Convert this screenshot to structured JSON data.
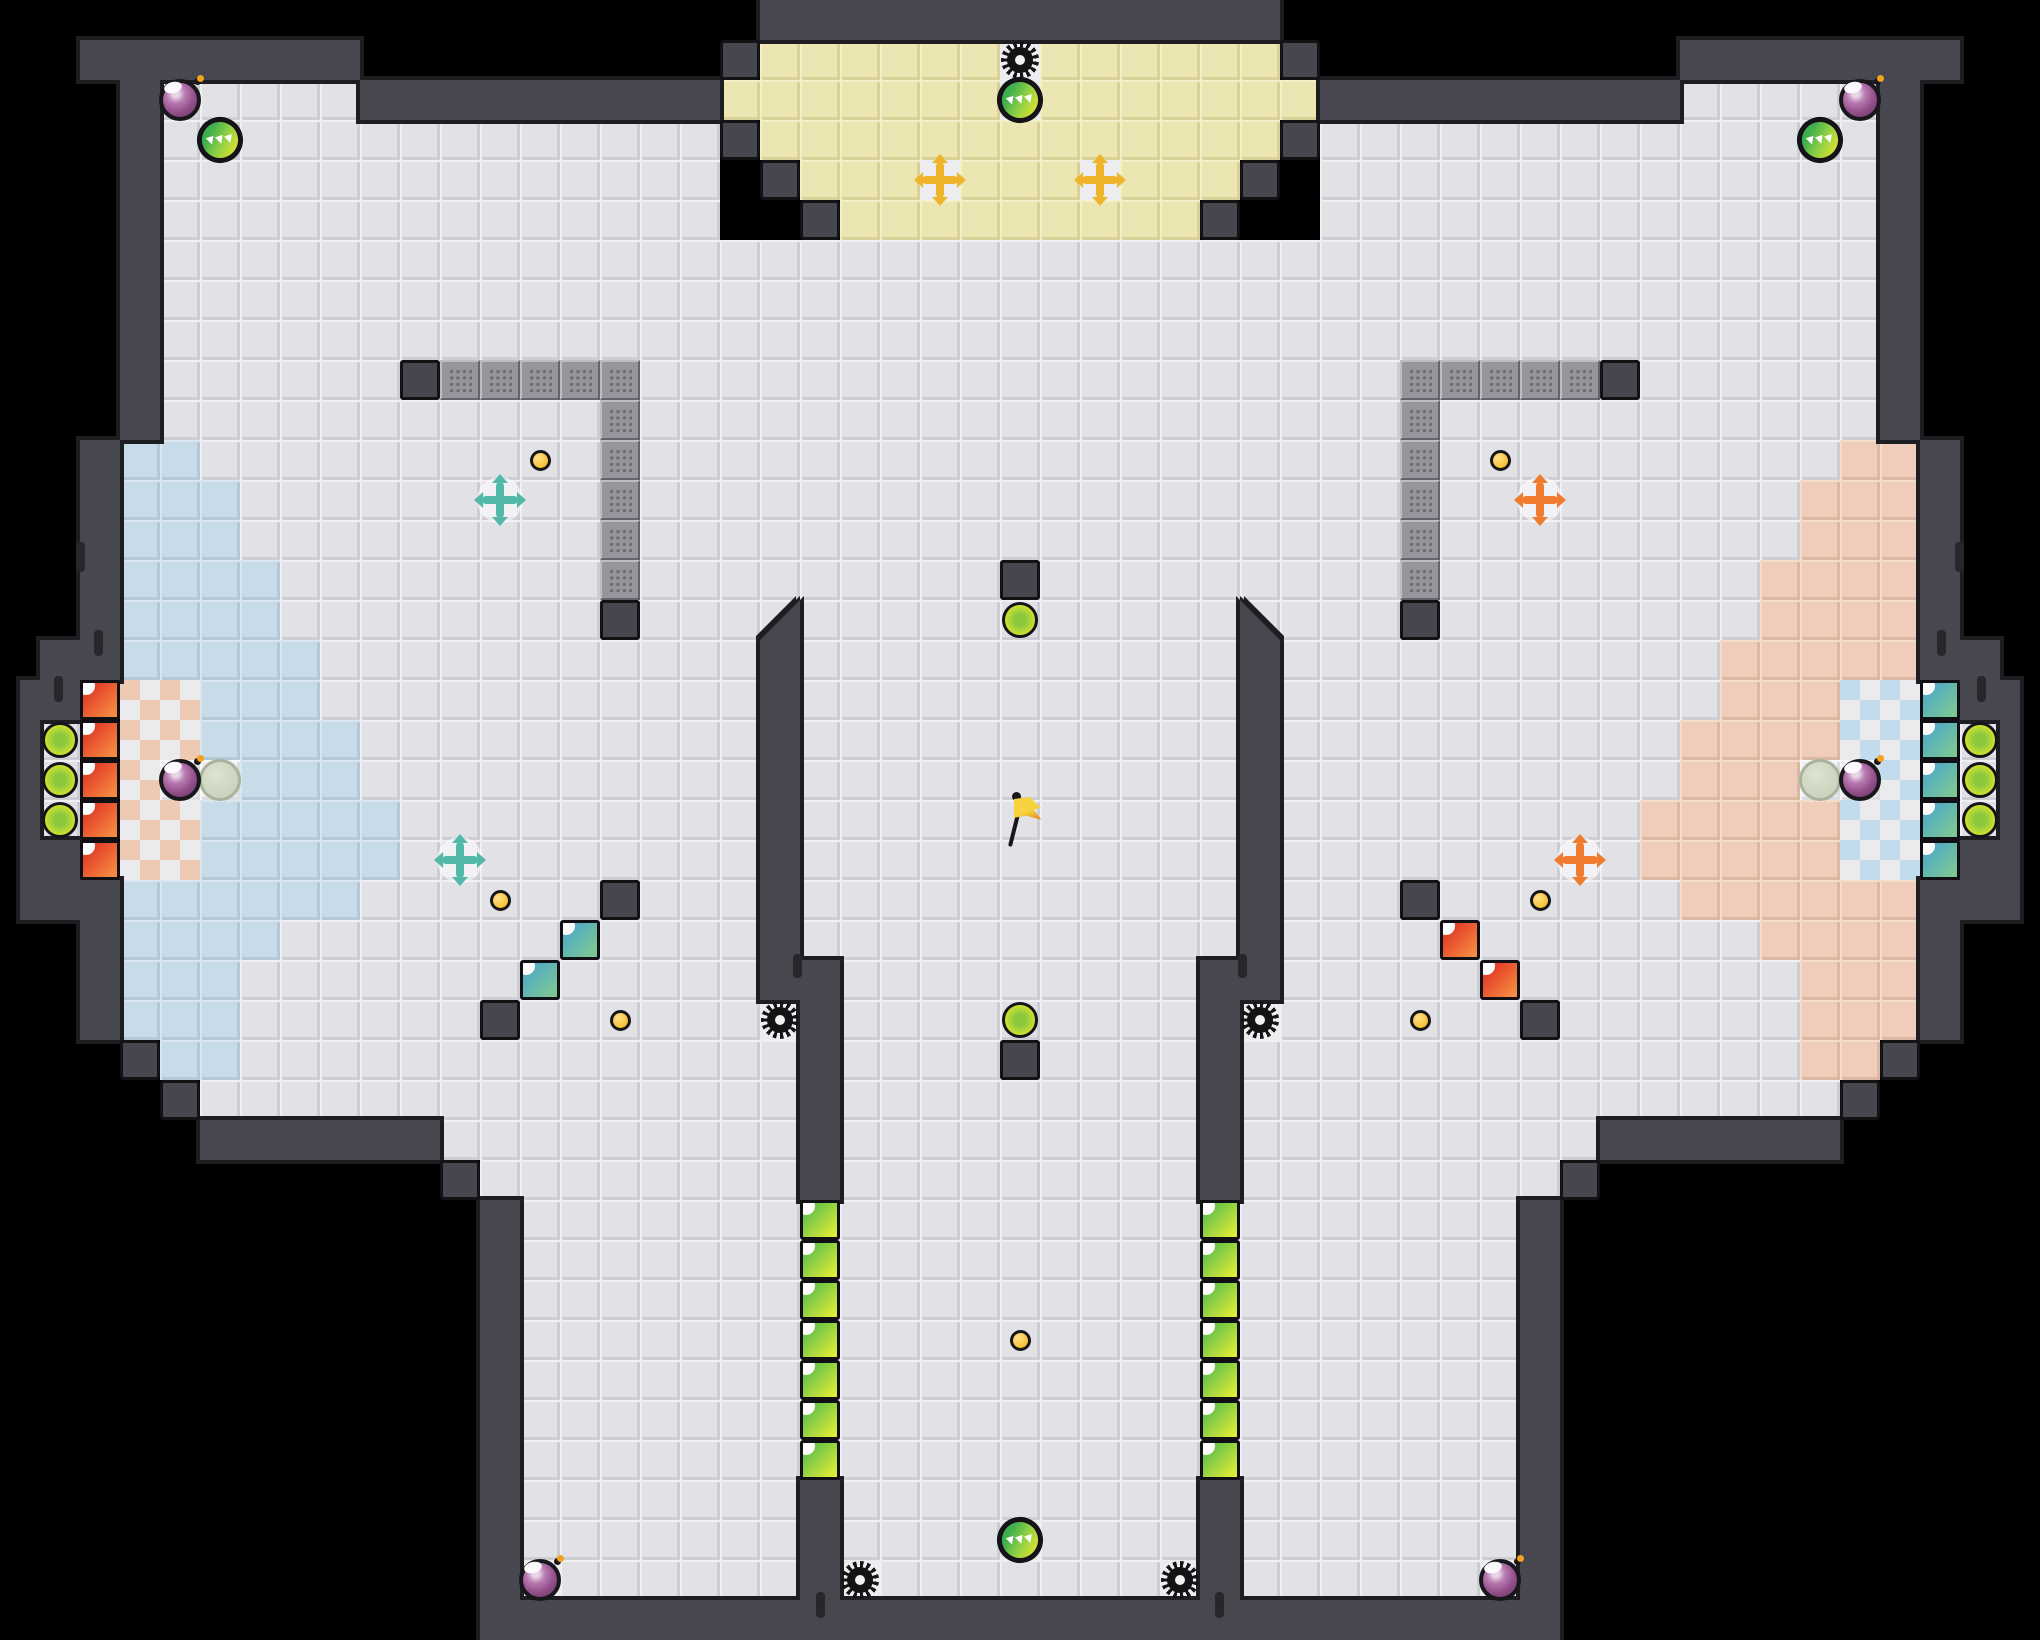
{
  "title": "tile arena map",
  "palette": {
    "background": "#000000",
    "wall_fill": "#47474f",
    "wall_outline": "#1d1d22",
    "floor_gray": "#e2e2e6",
    "floor_yellow": "#ece7b2",
    "floor_blue": "#c8dbe9",
    "floor_pink": "#f0cdba",
    "checker_left_accent": "#eec9b4",
    "checker_right_accent": "#c2dcee",
    "crate_red": "#e8452e",
    "crate_teal": "#58aec6",
    "crate_green": "#6fbf52",
    "cross_teal": "#53b8a8",
    "cross_orange": "#f07c30",
    "cross_gold": "#f0b42a",
    "orb_yellow_green": "#cfe32c",
    "bomb_purple": "#94518c",
    "gear_black": "#141417",
    "dot_gold": "#f3b512"
  },
  "map": {
    "tile": 40,
    "width": 2040,
    "height": 1640,
    "floors": {
      "gray": [
        [
          160,
          80,
          200,
          40
        ],
        [
          1680,
          80,
          200,
          40
        ],
        [
          160,
          120,
          560,
          120
        ],
        [
          1320,
          120,
          560,
          120
        ],
        [
          160,
          240,
          1720,
          200
        ],
        [
          120,
          440,
          1800,
          200
        ],
        [
          120,
          640,
          1800,
          40
        ],
        [
          160,
          680,
          1720,
          200
        ],
        [
          40,
          720,
          40,
          120
        ],
        [
          1960,
          720,
          40,
          120
        ],
        [
          120,
          880,
          1800,
          160
        ],
        [
          160,
          1040,
          1720,
          40
        ],
        [
          200,
          1080,
          1640,
          40
        ],
        [
          440,
          1120,
          1160,
          40
        ],
        [
          480,
          1160,
          1080,
          40
        ],
        [
          520,
          1200,
          1000,
          400
        ]
      ],
      "yellow": [
        [
          760,
          40,
          520,
          40
        ],
        [
          720,
          80,
          600,
          40
        ],
        [
          760,
          120,
          520,
          40
        ],
        [
          800,
          160,
          440,
          40
        ],
        [
          840,
          200,
          360,
          40
        ]
      ],
      "blue": [
        [
          120,
          440,
          80,
          40
        ],
        [
          120,
          480,
          120,
          40
        ],
        [
          120,
          520,
          120,
          40
        ],
        [
          120,
          560,
          160,
          40
        ],
        [
          120,
          600,
          160,
          40
        ],
        [
          120,
          640,
          200,
          40
        ],
        [
          160,
          680,
          160,
          40
        ],
        [
          160,
          720,
          200,
          40
        ],
        [
          240,
          760,
          120,
          40
        ],
        [
          160,
          800,
          240,
          40
        ],
        [
          160,
          840,
          240,
          40
        ],
        [
          120,
          880,
          240,
          40
        ],
        [
          120,
          920,
          160,
          40
        ],
        [
          120,
          960,
          120,
          40
        ],
        [
          120,
          1000,
          120,
          40
        ],
        [
          160,
          1040,
          80,
          40
        ]
      ],
      "pink": [
        [
          1840,
          440,
          80,
          40
        ],
        [
          1800,
          480,
          120,
          40
        ],
        [
          1800,
          520,
          120,
          40
        ],
        [
          1760,
          560,
          160,
          40
        ],
        [
          1760,
          600,
          160,
          40
        ],
        [
          1720,
          640,
          200,
          40
        ],
        [
          1720,
          680,
          160,
          40
        ],
        [
          1680,
          720,
          200,
          40
        ],
        [
          1680,
          760,
          120,
          40
        ],
        [
          1640,
          800,
          240,
          40
        ],
        [
          1640,
          840,
          240,
          40
        ],
        [
          1680,
          880,
          240,
          40
        ],
        [
          1760,
          920,
          160,
          40
        ],
        [
          1800,
          960,
          120,
          40
        ],
        [
          1800,
          1000,
          120,
          40
        ],
        [
          1800,
          1040,
          80,
          40
        ]
      ],
      "white": [
        [
          160,
          760,
          80,
          40
        ],
        [
          1800,
          760,
          80,
          40
        ]
      ],
      "pads": [
        [
          1000,
          40
        ],
        [
          1000,
          80
        ],
        [
          920,
          160
        ],
        [
          1080,
          160
        ],
        [
          760,
          1000
        ],
        [
          1240,
          1000
        ],
        [
          840,
          1560
        ],
        [
          1160,
          1560
        ],
        [
          1000,
          1520
        ],
        [
          520,
          1560
        ],
        [
          1480,
          1560
        ]
      ]
    },
    "checkers": {
      "left": [
        [
          120,
          680,
          40,
          200
        ],
        [
          160,
          680,
          40,
          80
        ],
        [
          160,
          800,
          40,
          80
        ]
      ],
      "right": [
        [
          1880,
          680,
          40,
          200
        ],
        [
          1840,
          680,
          40,
          80
        ],
        [
          1840,
          800,
          40,
          80
        ]
      ]
    },
    "bricks": [
      [
        440,
        360,
        200,
        40
      ],
      [
        600,
        400,
        40,
        200
      ],
      [
        1400,
        360,
        200,
        40
      ],
      [
        1400,
        400,
        40,
        200
      ]
    ],
    "walls": [
      [
        80,
        40,
        280,
        40
      ],
      [
        360,
        80,
        360,
        40
      ],
      [
        120,
        80,
        40,
        360
      ],
      [
        80,
        440,
        40,
        200
      ],
      [
        40,
        640,
        80,
        40
      ],
      [
        20,
        680,
        60,
        40
      ],
      [
        20,
        720,
        20,
        120
      ],
      [
        20,
        840,
        60,
        40
      ],
      [
        20,
        880,
        100,
        40
      ],
      [
        80,
        920,
        40,
        120
      ],
      [
        200,
        1120,
        240,
        40
      ],
      [
        480,
        1200,
        40,
        440
      ],
      [
        1680,
        40,
        280,
        40
      ],
      [
        1320,
        80,
        360,
        40
      ],
      [
        1880,
        80,
        40,
        360
      ],
      [
        1920,
        440,
        40,
        200
      ],
      [
        1920,
        640,
        80,
        40
      ],
      [
        1960,
        680,
        60,
        40
      ],
      [
        2000,
        720,
        20,
        120
      ],
      [
        1960,
        840,
        60,
        40
      ],
      [
        1920,
        880,
        100,
        40
      ],
      [
        1920,
        920,
        40,
        120
      ],
      [
        1600,
        1120,
        240,
        40
      ],
      [
        1520,
        1200,
        40,
        440
      ],
      [
        760,
        0,
        520,
        40
      ],
      [
        760,
        640,
        40,
        360
      ],
      [
        800,
        960,
        40,
        240
      ],
      [
        800,
        1480,
        40,
        120
      ],
      [
        1240,
        640,
        40,
        360
      ],
      [
        1200,
        960,
        40,
        240
      ],
      [
        1200,
        1480,
        40,
        120
      ],
      [
        480,
        1600,
        1080,
        40
      ]
    ],
    "bevels": [
      {
        "x": 760,
        "y": 600,
        "dir": "right"
      },
      {
        "x": 1240,
        "y": 600,
        "dir": "left"
      }
    ],
    "ticks": [
      [
        76,
        542,
        9,
        30
      ],
      [
        94,
        630,
        9,
        26
      ],
      [
        54,
        676,
        9,
        26
      ],
      [
        1955,
        542,
        9,
        30
      ],
      [
        1937,
        630,
        9,
        26
      ],
      [
        1977,
        676,
        9,
        26
      ],
      [
        793,
        954,
        9,
        24
      ],
      [
        1238,
        954,
        9,
        24
      ],
      [
        1215,
        1592,
        9,
        26
      ],
      [
        816,
        1592,
        9,
        26
      ]
    ],
    "blocks": [
      [
        400,
        360
      ],
      [
        600,
        600
      ],
      [
        1600,
        360
      ],
      [
        1400,
        600
      ],
      [
        720,
        40
      ],
      [
        1280,
        40
      ],
      [
        720,
        120
      ],
      [
        1280,
        120
      ],
      [
        760,
        160
      ],
      [
        1240,
        160
      ],
      [
        800,
        200
      ],
      [
        1200,
        200
      ],
      [
        1000,
        560
      ],
      [
        1000,
        1040
      ],
      [
        600,
        880
      ],
      [
        480,
        1000
      ],
      [
        1400,
        880
      ],
      [
        1520,
        1000
      ],
      [
        120,
        1040
      ],
      [
        160,
        1080
      ],
      [
        440,
        1160
      ],
      [
        1880,
        1040
      ],
      [
        1840,
        1080
      ],
      [
        1560,
        1160
      ]
    ],
    "crates": {
      "red": [
        [
          80,
          680
        ],
        [
          80,
          720
        ],
        [
          80,
          760
        ],
        [
          80,
          800
        ],
        [
          80,
          840
        ],
        [
          1440,
          920
        ],
        [
          1480,
          960
        ]
      ],
      "teal": [
        [
          1920,
          680
        ],
        [
          1920,
          720
        ],
        [
          1920,
          760
        ],
        [
          1920,
          800
        ],
        [
          1920,
          840
        ],
        [
          560,
          920
        ],
        [
          520,
          960
        ]
      ],
      "green": [
        [
          800,
          1200
        ],
        [
          800,
          1240
        ],
        [
          800,
          1280
        ],
        [
          800,
          1320
        ],
        [
          800,
          1360
        ],
        [
          800,
          1400
        ],
        [
          800,
          1440
        ],
        [
          1200,
          1200
        ],
        [
          1200,
          1240
        ],
        [
          1200,
          1280
        ],
        [
          1200,
          1320
        ],
        [
          1200,
          1360
        ],
        [
          1200,
          1400
        ],
        [
          1200,
          1440
        ]
      ]
    },
    "objects": {
      "bombs": [
        [
          180,
          100
        ],
        [
          1860,
          100
        ],
        [
          180,
          780
        ],
        [
          1860,
          780
        ],
        [
          540,
          1580
        ],
        [
          1500,
          1580
        ]
      ],
      "pickups": [
        [
          220,
          140
        ],
        [
          1820,
          140
        ],
        [
          1020,
          100
        ],
        [
          1020,
          1540
        ]
      ],
      "orbs": [
        [
          60,
          740
        ],
        [
          60,
          780
        ],
        [
          60,
          820
        ],
        [
          1980,
          740
        ],
        [
          1980,
          780
        ],
        [
          1980,
          820
        ],
        [
          1020,
          620
        ],
        [
          1020,
          1020
        ]
      ],
      "spawns": [
        [
          220,
          780
        ],
        [
          1820,
          780
        ]
      ],
      "gears": [
        [
          1020,
          60
        ],
        [
          780,
          1020
        ],
        [
          1260,
          1020
        ],
        [
          860,
          1580
        ],
        [
          1180,
          1580
        ]
      ],
      "dots": [
        [
          540,
          460
        ],
        [
          1500,
          460
        ],
        [
          500,
          900
        ],
        [
          1540,
          900
        ],
        [
          620,
          1020
        ],
        [
          1420,
          1020
        ],
        [
          1020,
          1340
        ]
      ],
      "crosses": [
        {
          "x": 500,
          "y": 500,
          "c": "teal"
        },
        {
          "x": 460,
          "y": 860,
          "c": "teal"
        },
        {
          "x": 1540,
          "y": 500,
          "c": "orange"
        },
        {
          "x": 1580,
          "y": 860,
          "c": "orange"
        },
        {
          "x": 940,
          "y": 180,
          "c": "gold"
        },
        {
          "x": 1100,
          "y": 180,
          "c": "gold"
        }
      ],
      "glows": [
        [
          500,
          500
        ],
        [
          460,
          860
        ],
        [
          1540,
          500
        ],
        [
          1580,
          860
        ]
      ],
      "flag": [
        1020,
        820
      ]
    }
  }
}
